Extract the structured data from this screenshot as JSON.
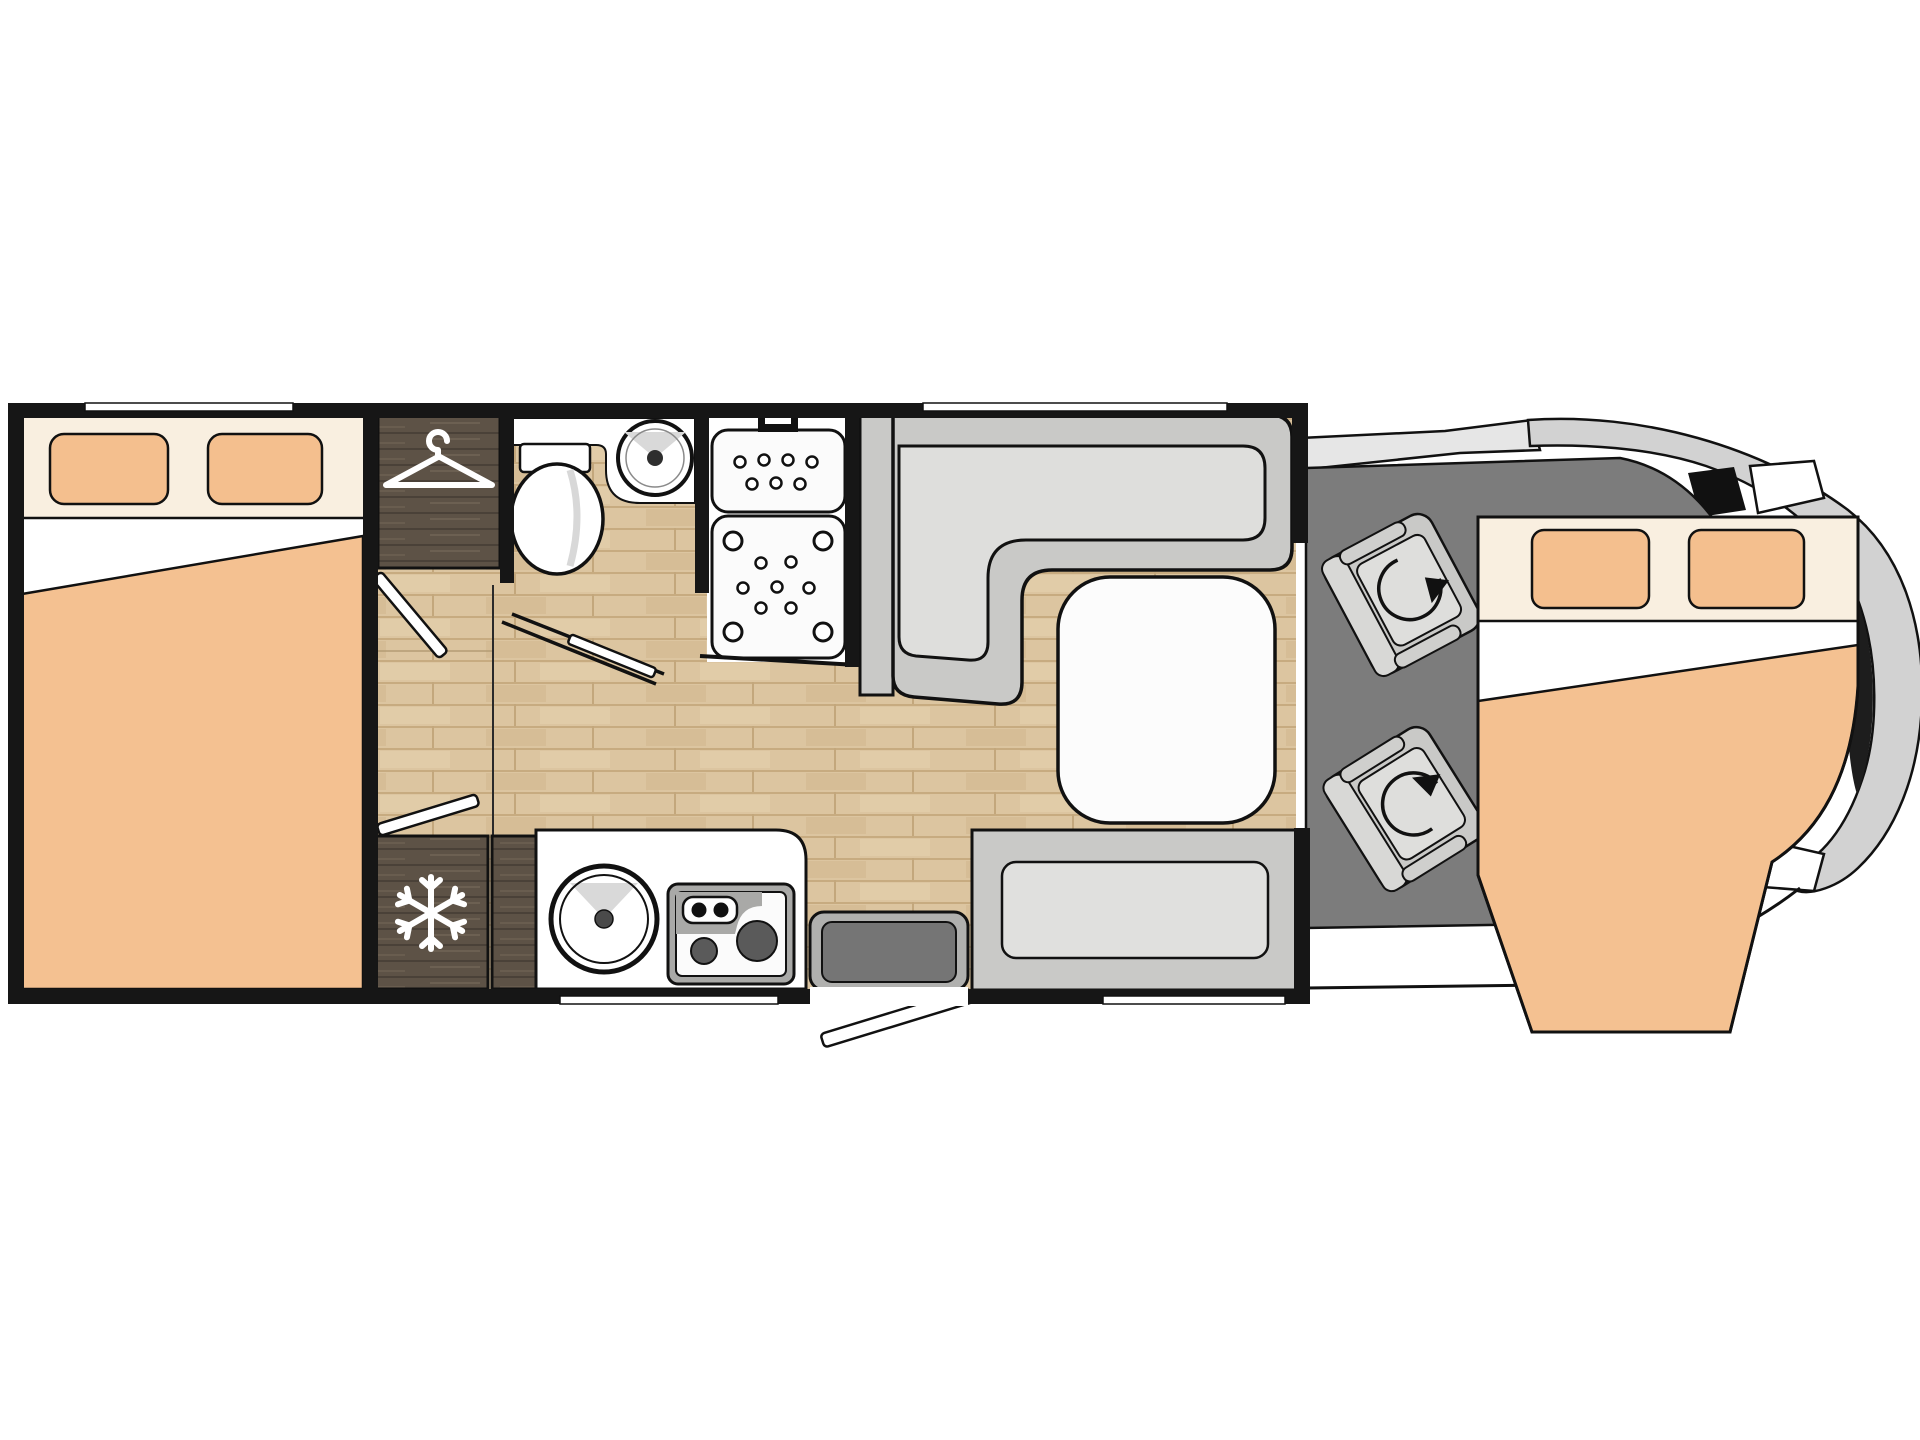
{
  "document": {
    "kind": "motorhome-floorplan",
    "background": "#ffffff"
  },
  "colors": {
    "wall": "#161616",
    "outline": "#111111",
    "bed_header_cream": "#f9efe0",
    "pillow_peach": "#f4bf8e",
    "blanket_peach": "#f4c191",
    "sheet_white": "#ffffff",
    "wood_floor": "#dcc5a0",
    "wood_floor_line": "#c7ab80",
    "cabinet_dark_wood": "#5d5246",
    "cabinet_wood_streak": "#6c6052",
    "seat_gray": "#c9c9c7",
    "cushion_gray": "#dededc",
    "bench_cushion": "#e0e0de",
    "sideboard_gray": "#c9c9c7",
    "table_white": "#fcfcfc",
    "cab_floor_gray": "#7c7c7c",
    "body_gray": "#d2d2d2",
    "body_band_gray": "#e6e6e6",
    "step_outer": "#b0b0ae",
    "step_inner": "#757575",
    "burner_gray": "#5a5a5a",
    "stove_frame": "#a9a9a7",
    "fixture_white": "#fbfbfb",
    "icon_white": "#ffffff"
  },
  "icons": [
    {
      "name": "hanger-icon",
      "meaning": "wardrobe"
    },
    {
      "name": "snowflake-icon",
      "meaning": "refrigerator"
    },
    {
      "name": "rotation-arrow-icon",
      "meaning": "swivel cab seat",
      "count": 2
    },
    {
      "name": "shower-door-handle-icon",
      "meaning": "shower entry"
    }
  ],
  "rooms": [
    {
      "name": "rear-bedroom"
    },
    {
      "name": "wardrobe"
    },
    {
      "name": "washroom"
    },
    {
      "name": "shower"
    },
    {
      "name": "kitchen"
    },
    {
      "name": "dinette"
    },
    {
      "name": "cab"
    },
    {
      "name": "front-bed"
    }
  ],
  "furniture": [
    {
      "name": "rear-bed",
      "pillows": 2
    },
    {
      "name": "toilet"
    },
    {
      "name": "wash-basin"
    },
    {
      "name": "shower-tray",
      "sections": 2
    },
    {
      "name": "refrigerator"
    },
    {
      "name": "kitchen-sink"
    },
    {
      "name": "stove",
      "burners": 2,
      "knobs": 2
    },
    {
      "name": "l-shaped-dinette-seat"
    },
    {
      "name": "dinette-table"
    },
    {
      "name": "bench-seat"
    },
    {
      "name": "swivel-cab-seat",
      "count": 2
    },
    {
      "name": "entry-step"
    },
    {
      "name": "front-bed",
      "pillows": 2
    }
  ]
}
